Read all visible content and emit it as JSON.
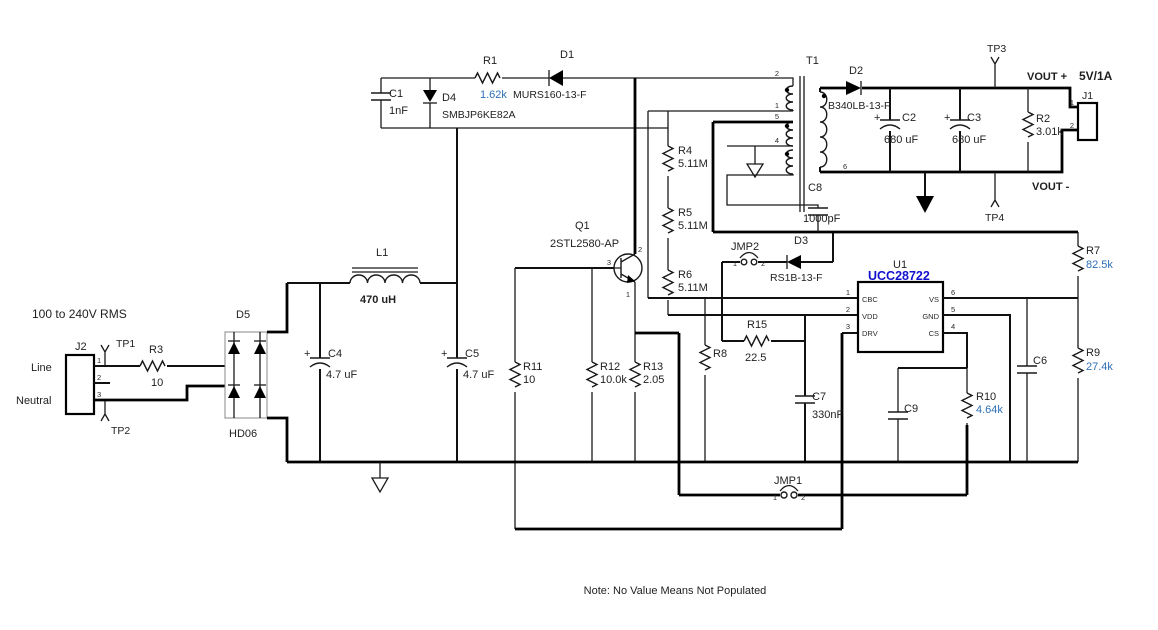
{
  "note": "Note: No Value Means Not Populated",
  "colors": {
    "value_text": "#2e6fb7",
    "ic_text": "#1111cd",
    "wire": "#000000"
  },
  "sym": {
    "plus": "+"
  },
  "ac_input": {
    "rating": "100 to 240V RMS",
    "line_label": "Line",
    "neutral_label": "Neutral",
    "j2": {
      "ref": "J2",
      "pin1": "1",
      "pin2": "2",
      "pin3": "3"
    },
    "tp1": {
      "ref": "TP1"
    },
    "tp2": {
      "ref": "TP2"
    },
    "r3": {
      "ref": "R3",
      "value": "10"
    },
    "d5": {
      "ref": "D5",
      "part": "HD06"
    }
  },
  "bulk": {
    "c4": {
      "ref": "C4",
      "value": "4.7 uF"
    },
    "c5": {
      "ref": "C5",
      "value": "4.7 uF"
    },
    "l1": {
      "ref": "L1",
      "value": "470 uH"
    }
  },
  "clamp": {
    "c1": {
      "ref": "C1",
      "value": "1nF"
    },
    "d4": {
      "ref": "D4",
      "part": "SMBJP6KE82A"
    },
    "r1": {
      "ref": "R1",
      "value": "1.62k"
    },
    "d1": {
      "ref": "D1",
      "part": "MURS160-13-F"
    }
  },
  "transformer": {
    "ref": "T1",
    "pin2": "2",
    "pin1": "1",
    "pin5": "5",
    "pin4": "4",
    "pin6": "6"
  },
  "startup": {
    "r4": {
      "ref": "R4",
      "value": "5.11M"
    },
    "r5": {
      "ref": "R5",
      "value": "5.11M"
    },
    "r6": {
      "ref": "R6",
      "value": "5.11M"
    }
  },
  "switching": {
    "q1": {
      "ref": "Q1",
      "part": "2STL2580-AP",
      "pin_c": "2",
      "pin_b": "3",
      "pin_e": "1"
    },
    "r11": {
      "ref": "R11",
      "value": "10"
    },
    "r12": {
      "ref": "R12",
      "value": "10.0k"
    },
    "r13": {
      "ref": "R13",
      "value": "2.05"
    },
    "r8": {
      "ref": "R8"
    }
  },
  "controller": {
    "u1": {
      "ref": "U1",
      "part": "UCC28722",
      "pin1_num": "1",
      "pin1_name": "CBC",
      "pin2_num": "2",
      "pin2_name": "VDD",
      "pin3_num": "3",
      "pin3_name": "DRV",
      "pin4_num": "4",
      "pin4_name": "CS",
      "pin5_num": "5",
      "pin5_name": "GND",
      "pin6_num": "6",
      "pin6_name": "VS"
    },
    "r15": {
      "ref": "R15",
      "value": "22.5"
    },
    "c7": {
      "ref": "C7",
      "value": "330nF"
    },
    "c9": {
      "ref": "C9"
    },
    "c6": {
      "ref": "C6"
    },
    "r10": {
      "ref": "R10",
      "value": "4.64k"
    },
    "r7": {
      "ref": "R7",
      "value": "82.5k"
    },
    "r9": {
      "ref": "R9",
      "value": "27.4k"
    },
    "d3": {
      "ref": "D3",
      "part": "RS1B-13-F"
    },
    "jmp2": {
      "ref": "JMP2",
      "pin1": "1",
      "pin2": "2"
    },
    "jmp1": {
      "ref": "JMP1",
      "pin1": "1",
      "pin2": "2"
    },
    "c8": {
      "ref": "C8",
      "value": "1000pF"
    }
  },
  "output": {
    "d2": {
      "ref": "D2",
      "part": "B340LB-13-F"
    },
    "c2": {
      "ref": "C2",
      "value": "680 uF"
    },
    "c3": {
      "ref": "C3",
      "value": "680 uF"
    },
    "r2": {
      "ref": "R2",
      "value": "3.01k"
    },
    "tp3": {
      "ref": "TP3"
    },
    "tp4": {
      "ref": "TP4"
    },
    "j1": {
      "ref": "J1",
      "pin1": "1",
      "pin2": "2"
    },
    "vout_plus": "VOUT +",
    "vout_minus": "VOUT -",
    "rating": "5V/1A"
  }
}
